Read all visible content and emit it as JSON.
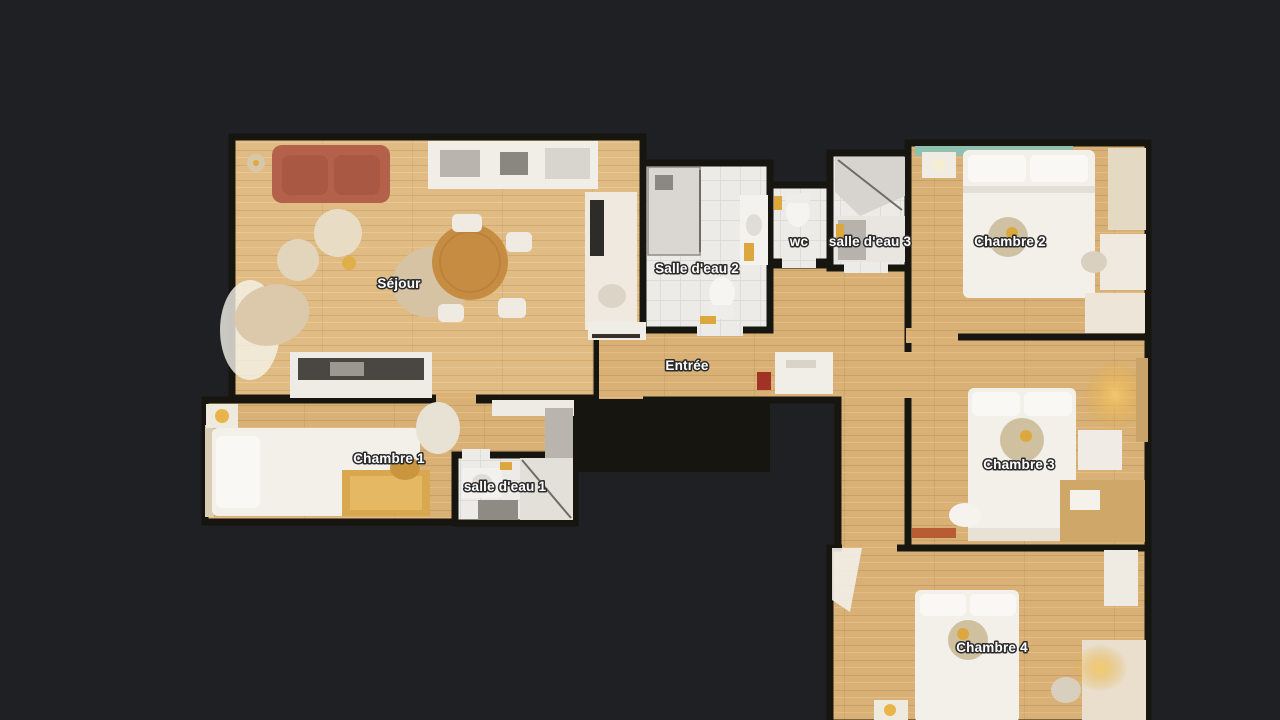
{
  "canvas": {
    "background_color": "#1e2023",
    "wall_color": "#17150f",
    "wood_color": "#d9b176",
    "wood_light_color": "#e0bc84",
    "tile_color": "#ecebe7",
    "label_color": "#ffffff",
    "sofa_color": "#b4614c",
    "table_wood_color": "#c68d42",
    "headboard_teal_color": "#8fc0b0",
    "lamp_gold_color": "#e3a93c"
  },
  "floorplan": {
    "view": "top-down 3D scan floor plan",
    "rooms": [
      {
        "id": "sejour",
        "label": "Séjour"
      },
      {
        "id": "salle-deau-2",
        "label": "Salle d'eau 2"
      },
      {
        "id": "wc",
        "label": "wc"
      },
      {
        "id": "salle-deau-3",
        "label": "salle d'eau 3"
      },
      {
        "id": "chambre-2",
        "label": "Chambre 2"
      },
      {
        "id": "entree",
        "label": "Entrée"
      },
      {
        "id": "chambre-1",
        "label": "Chambre 1"
      },
      {
        "id": "salle-deau-1",
        "label": "salle d'eau 1"
      },
      {
        "id": "chambre-3",
        "label": "Chambre 3"
      },
      {
        "id": "chambre-4",
        "label": "Chambre 4"
      }
    ]
  }
}
